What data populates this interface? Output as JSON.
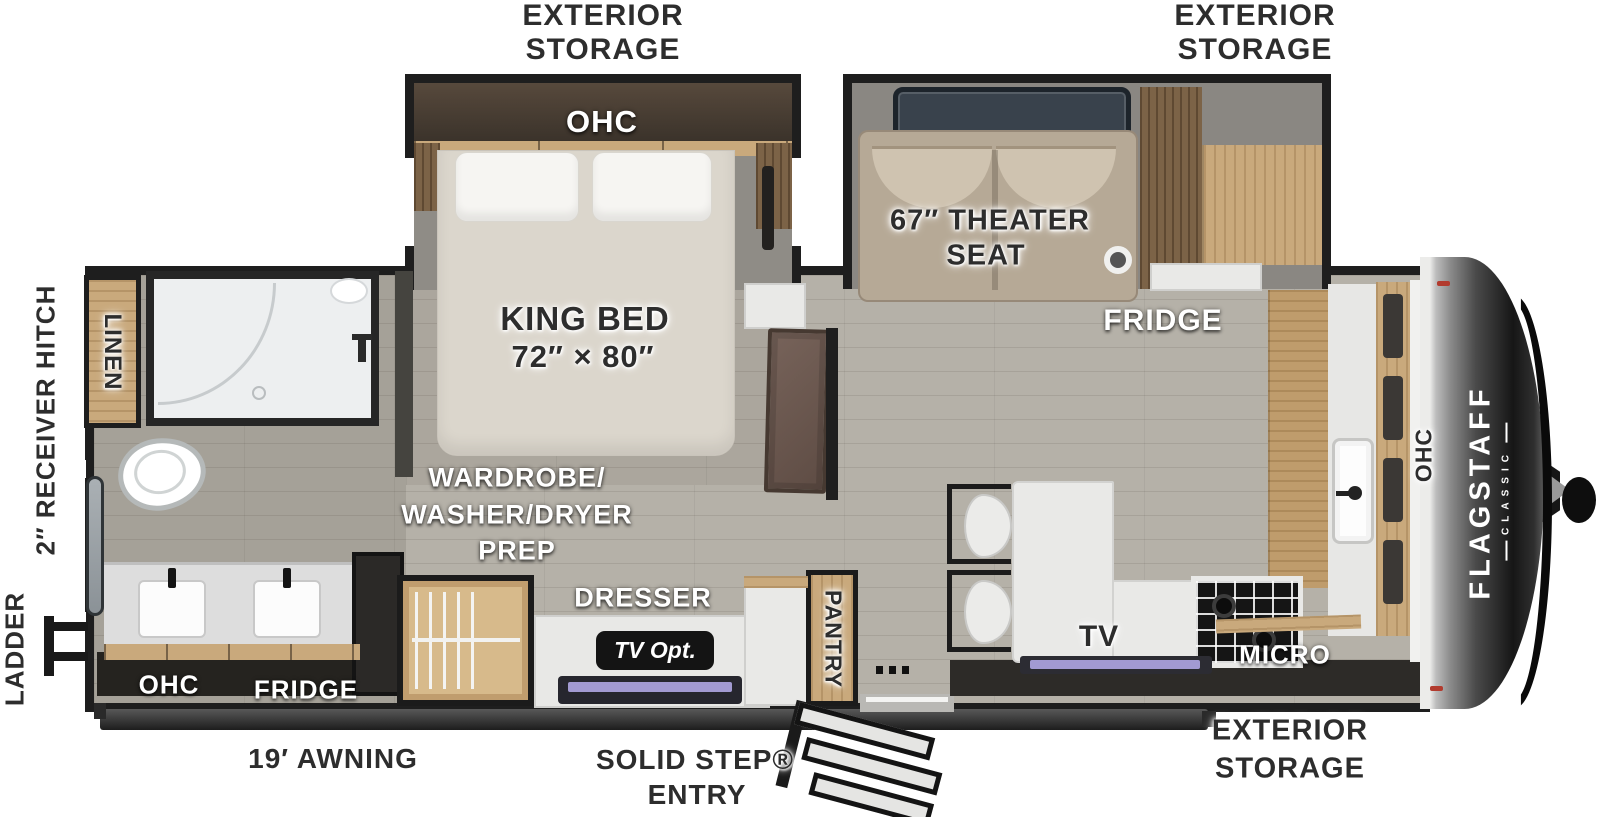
{
  "floorplan": {
    "brand": {
      "name": "FLAGSTAFF",
      "series": "CLASSIC"
    },
    "exterior": {
      "storage_top_left": {
        "l1": "EXTERIOR",
        "l2": "STORAGE"
      },
      "storage_top_right": {
        "l1": "EXTERIOR",
        "l2": "STORAGE"
      },
      "storage_bottom_right": {
        "l1": "EXTERIOR",
        "l2": "STORAGE"
      },
      "receiver_hitch": "2″ RECEIVER HITCH",
      "ladder": "LADDER",
      "awning": "19′ AWNING",
      "entry": {
        "l1": "SOLID STEP®",
        "l2": "ENTRY"
      }
    },
    "bedroom": {
      "ohc": "OHC",
      "bed": {
        "l1": "KING BED",
        "l2": "72″ × 80″"
      }
    },
    "bathroom": {
      "linen": "LINEN",
      "ohc": "OHC",
      "fridge": "FRIDGE"
    },
    "living": {
      "theater": {
        "l1": "67″ THEATER",
        "l2": "SEAT"
      },
      "fridge": "FRIDGE",
      "tv": "TV"
    },
    "mid": {
      "wardrobe": {
        "l1": "WARDROBE/",
        "l2": "WASHER/DRYER",
        "l3": "PREP"
      },
      "dresser": "DRESSER",
      "tv_opt": "TV Opt.",
      "pantry": "PANTRY"
    },
    "kitchen": {
      "micro": "MICRO",
      "ohc": "OHC"
    }
  },
  "colors": {
    "wall": "#1e1e1e",
    "floor": "#b5b1a8",
    "wood": "#c6a77a",
    "label_dark": "#2d2d2d",
    "tv_screen": "#a29ad2",
    "seat_tan": "#b9ac99"
  }
}
